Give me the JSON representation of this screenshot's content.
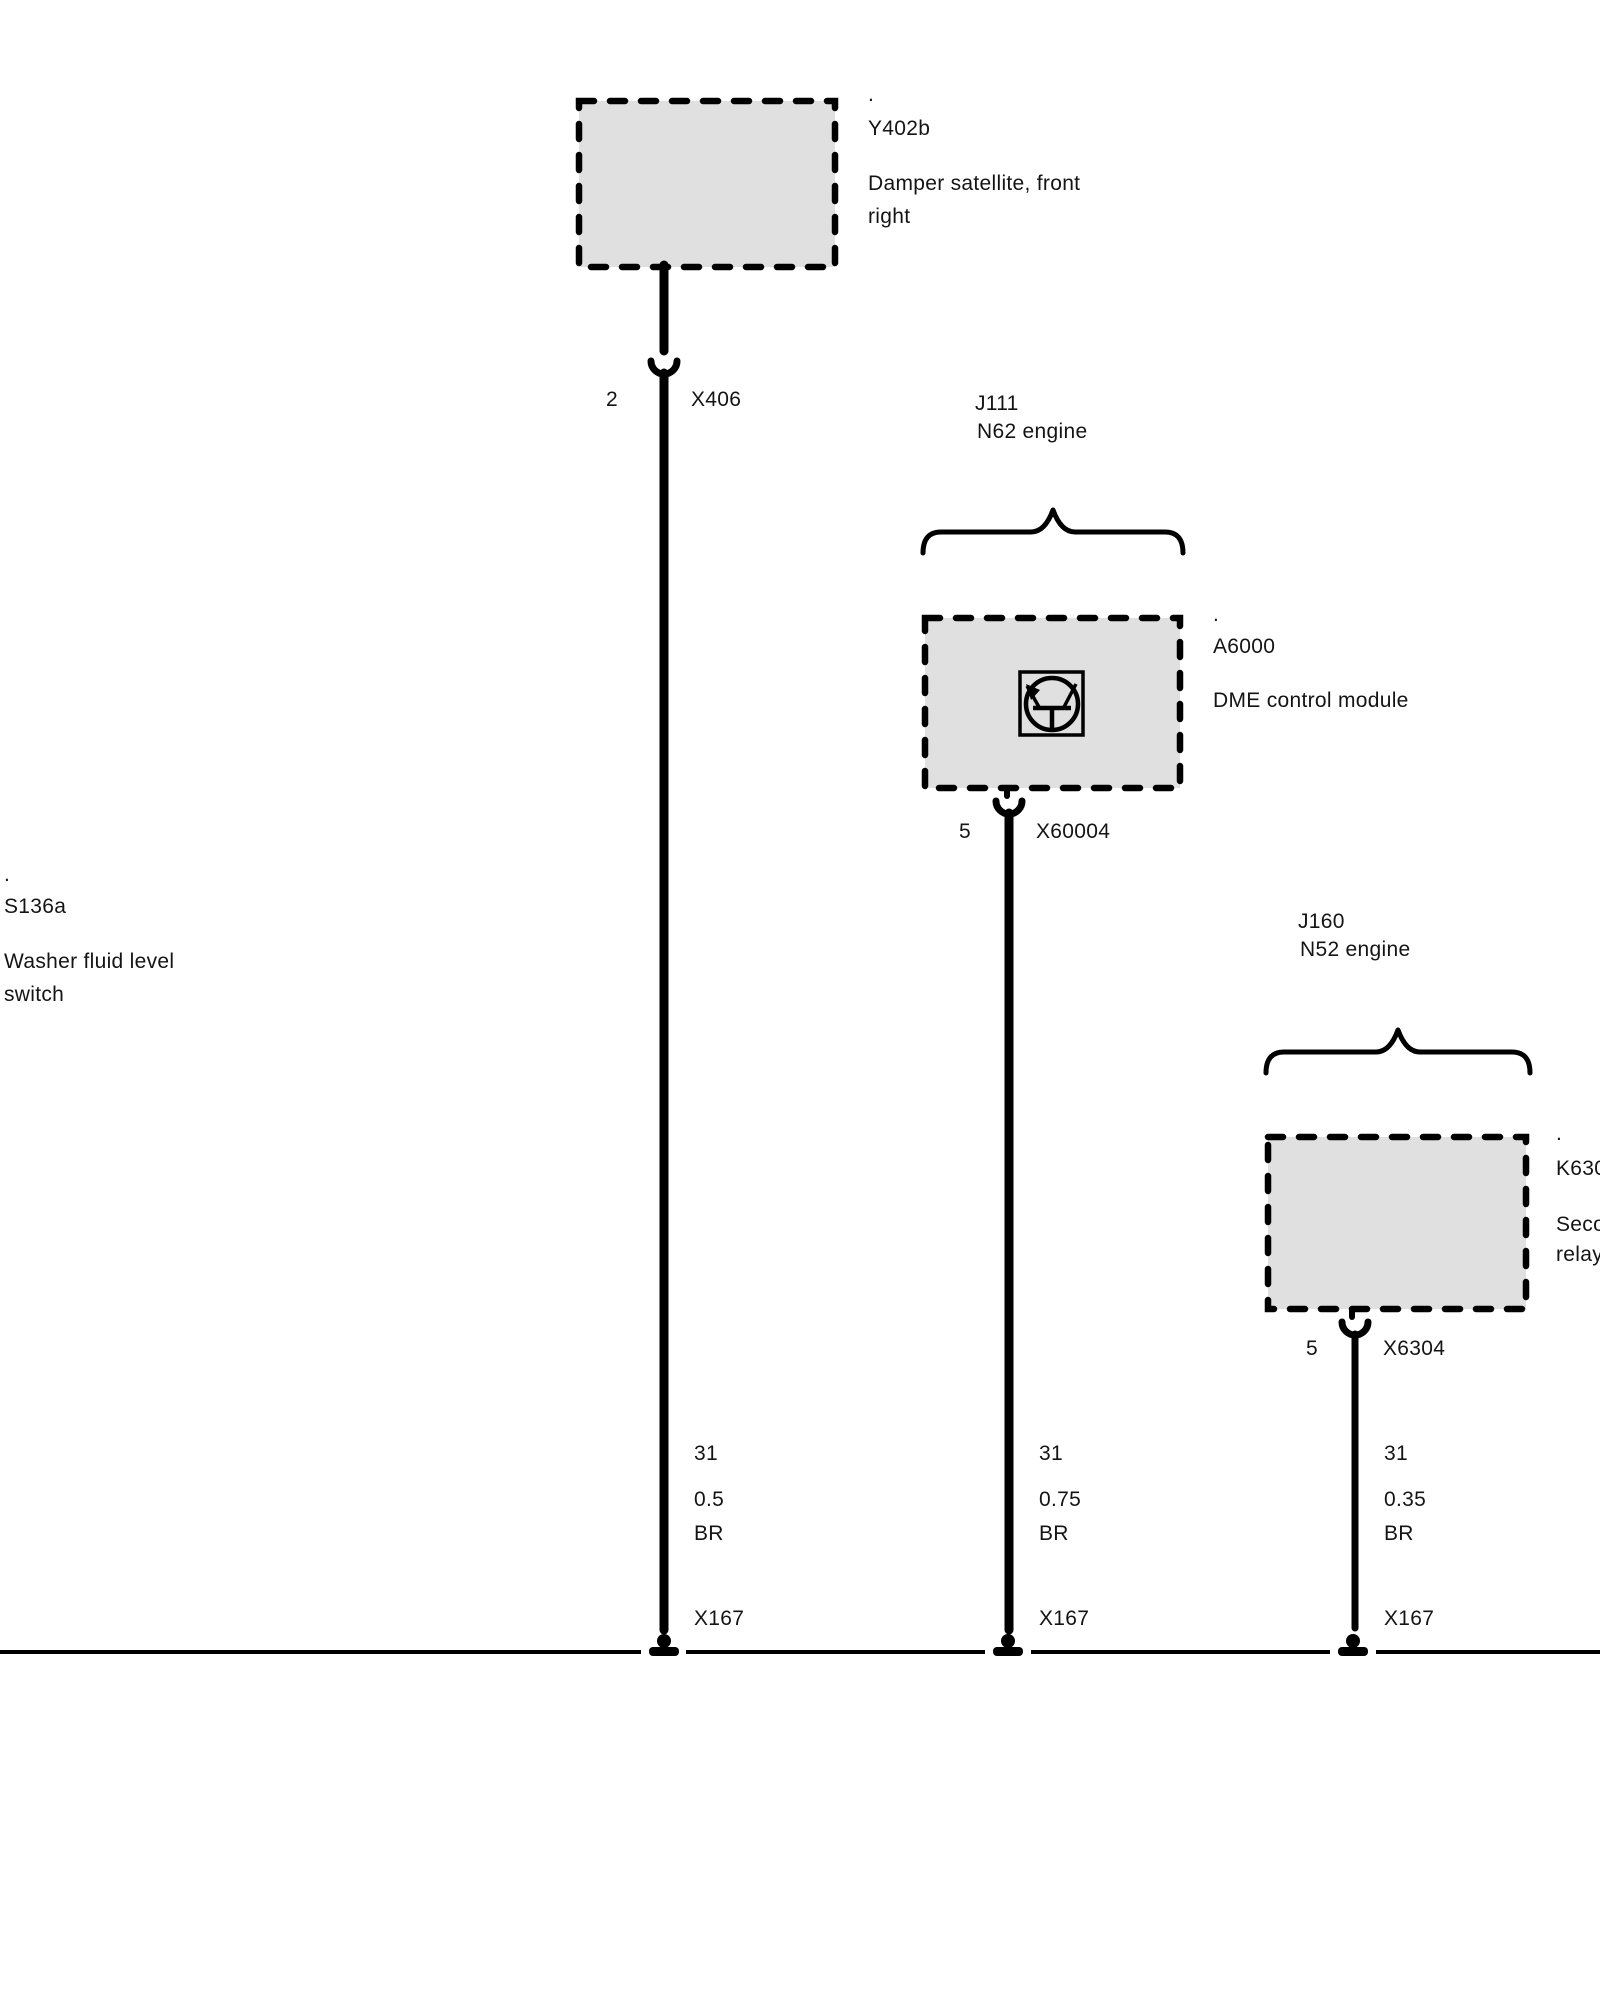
{
  "colors": {
    "background": "#ffffff",
    "line_color": "#000000",
    "module_fill": "#e0e0e0",
    "text_color": "#141414"
  },
  "modules": {
    "damper_satellite": {
      "dot": ".",
      "id": "Y402b",
      "desc1": "Damper satellite, front",
      "desc2": "right"
    },
    "dme_module": {
      "dot": ".",
      "id": "A6000",
      "desc1": "DME control module"
    },
    "relay_module": {
      "dot": ".",
      "id": "K6300",
      "desc1": "Secondary",
      "desc2": "relay"
    },
    "washer_switch": {
      "dot": ".",
      "id": "S136a",
      "desc1": "Washer fluid level",
      "desc2": "switch"
    }
  },
  "engine_groups": {
    "j111": {
      "id": "J111",
      "engine": "N62 engine"
    },
    "j160": {
      "id": "J160",
      "engine": "N52 engine"
    }
  },
  "connectors": {
    "x406": {
      "pin": "2",
      "name": "X406"
    },
    "x60004": {
      "pin": "5",
      "name": "X60004"
    },
    "x6304": {
      "pin": "5",
      "name": "X6304"
    }
  },
  "wires": {
    "w1": {
      "circuit": "31",
      "size": "0.5",
      "color": "BR",
      "ground": "X167"
    },
    "w2": {
      "circuit": "31",
      "size": "0.75",
      "color": "BR",
      "ground": "X167"
    },
    "w3": {
      "circuit": "31",
      "size": "0.35",
      "color": "BR",
      "ground": "X167"
    }
  }
}
